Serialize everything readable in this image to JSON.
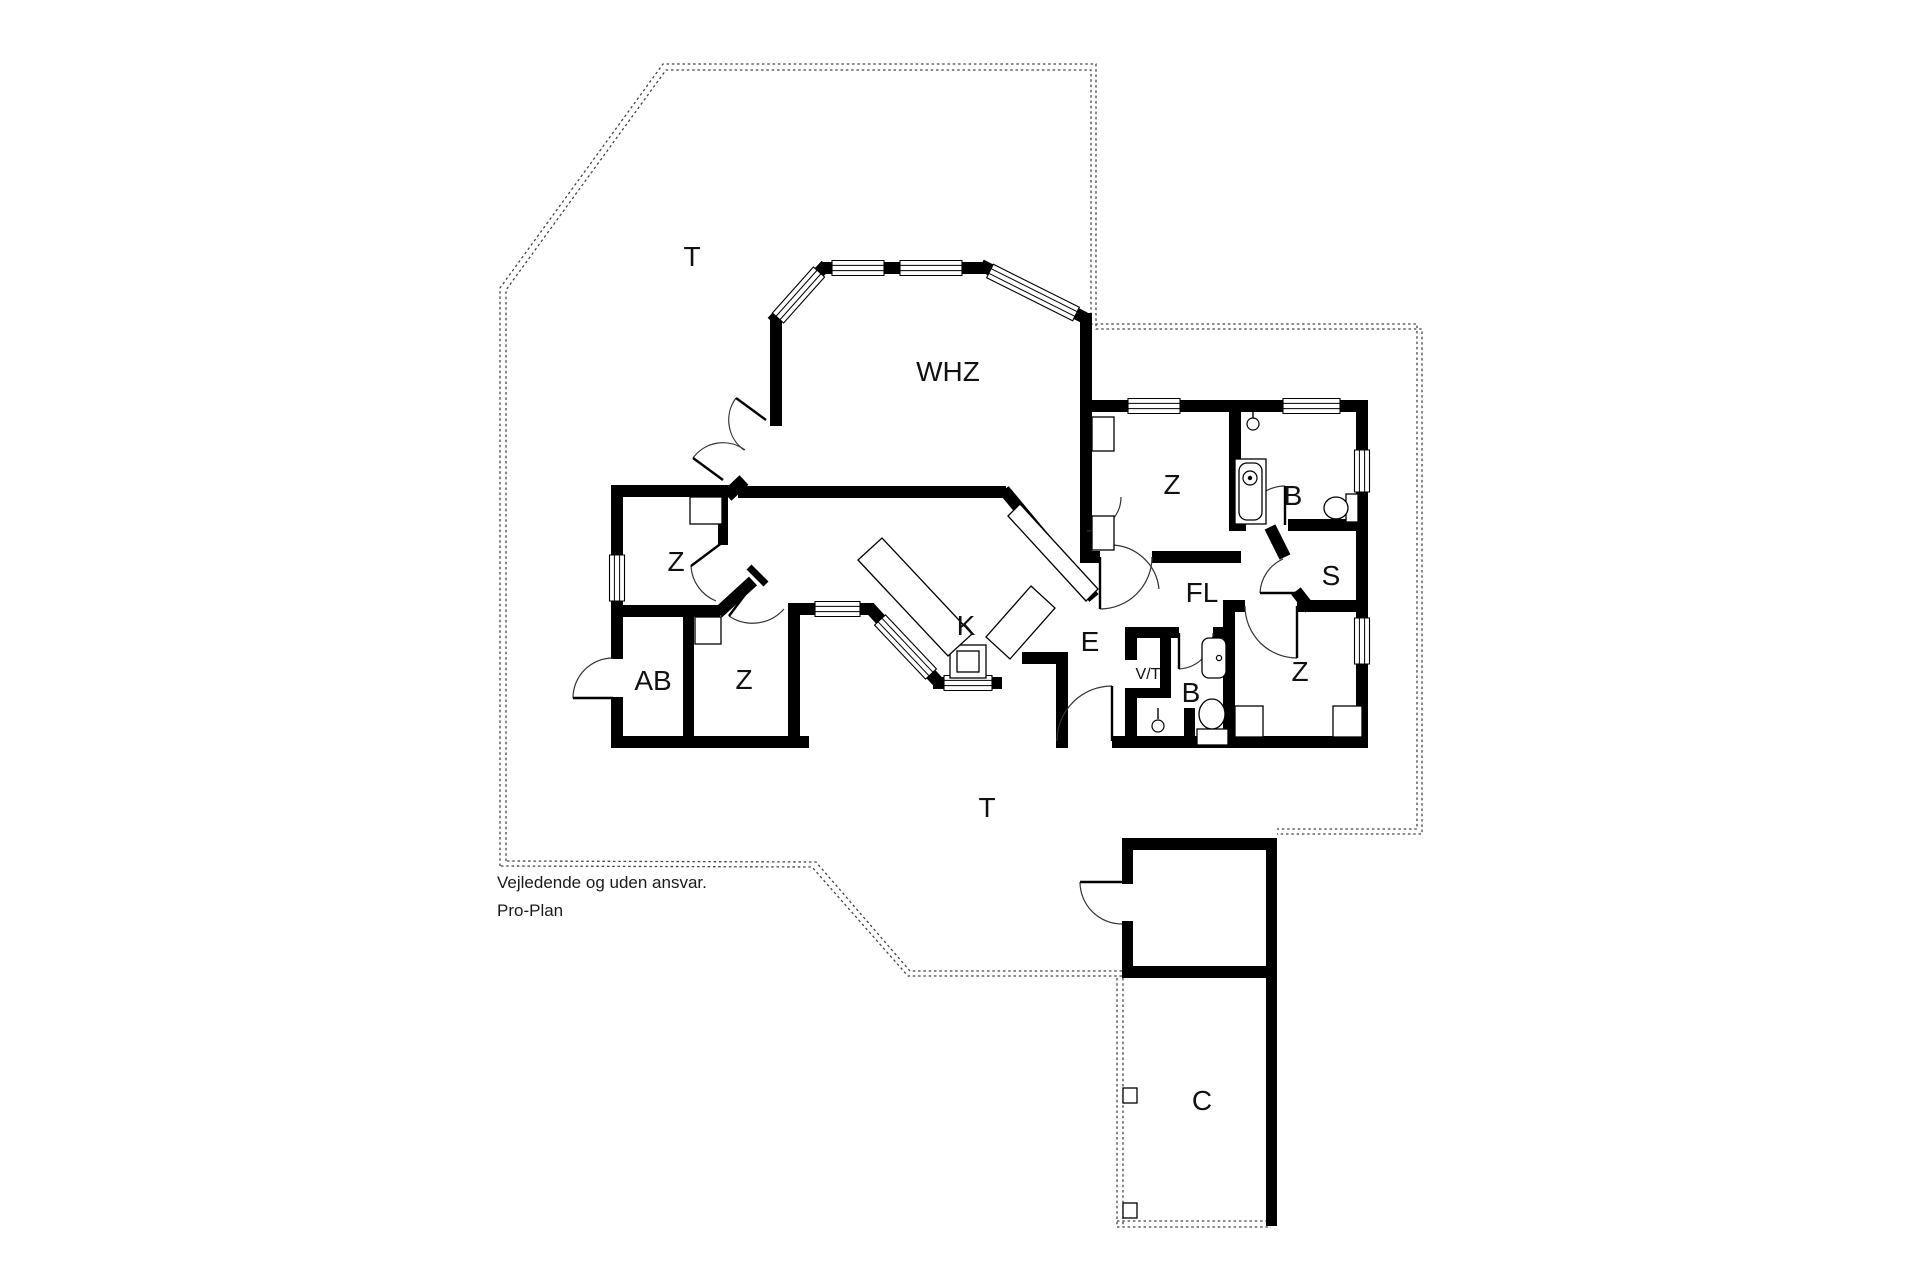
{
  "disclaimer": {
    "line1": "Vejledende og uden ansvar.",
    "line2": "Pro-Plan"
  },
  "colors": {
    "wall": "#000000",
    "paper": "#ffffff",
    "boundary_dash": "#444444",
    "label_text": "#111111"
  },
  "room_labels": [
    {
      "id": "terrace-top",
      "text": "T",
      "x": 692,
      "y": 266,
      "size": 28
    },
    {
      "id": "living-room",
      "text": "WHZ",
      "x": 948,
      "y": 381,
      "size": 28
    },
    {
      "id": "bedroom-top-right",
      "text": "Z",
      "x": 1172,
      "y": 494,
      "size": 28
    },
    {
      "id": "bath-top",
      "text": "B",
      "x": 1293,
      "y": 505,
      "size": 28
    },
    {
      "id": "sauna",
      "text": "S",
      "x": 1331,
      "y": 585,
      "size": 28
    },
    {
      "id": "hall",
      "text": "FL",
      "x": 1202,
      "y": 602,
      "size": 28
    },
    {
      "id": "bedroom-left-upper",
      "text": "Z",
      "x": 676,
      "y": 571,
      "size": 28
    },
    {
      "id": "utility-ab",
      "text": "AB",
      "x": 653,
      "y": 690,
      "size": 28
    },
    {
      "id": "bedroom-left-lower",
      "text": "Z",
      "x": 744,
      "y": 689,
      "size": 28
    },
    {
      "id": "kitchen",
      "text": "K",
      "x": 966,
      "y": 635,
      "size": 28
    },
    {
      "id": "dining",
      "text": "E",
      "x": 1090,
      "y": 651,
      "size": 28
    },
    {
      "id": "washer-dryer",
      "text": "V/T",
      "x": 1148,
      "y": 679,
      "size": 16
    },
    {
      "id": "bath-bottom",
      "text": "B",
      "x": 1191,
      "y": 702,
      "size": 28
    },
    {
      "id": "bedroom-bottom-right",
      "text": "Z",
      "x": 1300,
      "y": 681,
      "size": 28
    },
    {
      "id": "terrace-bottom",
      "text": "T",
      "x": 987,
      "y": 817,
      "size": 28
    },
    {
      "id": "carport",
      "text": "C",
      "x": 1202,
      "y": 1110,
      "size": 28
    }
  ],
  "geometry": {
    "walls": [
      [
        822,
        262,
        163,
        12
      ],
      [
        770,
        318,
        12,
        108
      ],
      [
        1080,
        313,
        12,
        99
      ],
      [
        1085,
        400,
        283,
        12
      ],
      [
        1356,
        400,
        12,
        348
      ],
      [
        1112,
        736,
        256,
        12
      ],
      [
        1058,
        736,
        10,
        12
      ],
      [
        738,
        486,
        268,
        12
      ],
      [
        613,
        485,
        119,
        12
      ],
      [
        611,
        485,
        12,
        122
      ],
      [
        613,
        605,
        107,
        12
      ],
      [
        683,
        605,
        11,
        143
      ],
      [
        611,
        607,
        12,
        52
      ],
      [
        611,
        697,
        12,
        51
      ],
      [
        611,
        736,
        198,
        12
      ],
      [
        788,
        605,
        12,
        143
      ],
      [
        788,
        603,
        86,
        12
      ],
      [
        933,
        677,
        69,
        12
      ],
      [
        1022,
        652,
        46,
        12
      ],
      [
        1056,
        652,
        12,
        96
      ],
      [
        1080,
        412,
        12,
        151
      ],
      [
        1080,
        551,
        20,
        12
      ],
      [
        1152,
        551,
        89,
        12
      ],
      [
        1229,
        412,
        12,
        119
      ],
      [
        1229,
        519,
        17,
        12
      ],
      [
        1288,
        519,
        80,
        12
      ],
      [
        1223,
        600,
        22,
        12
      ],
      [
        1297,
        600,
        71,
        12
      ],
      [
        1223,
        600,
        12,
        148
      ],
      [
        1125,
        627,
        54,
        11
      ],
      [
        1213,
        627,
        21,
        11
      ],
      [
        1125,
        627,
        12,
        33
      ],
      [
        1125,
        688,
        12,
        60
      ],
      [
        1160,
        638,
        11,
        60
      ],
      [
        1125,
        688,
        46,
        10
      ],
      [
        1184,
        708,
        11,
        34
      ],
      [
        1122,
        838,
        155,
        12
      ],
      [
        1122,
        838,
        11,
        46
      ],
      [
        1122,
        921,
        11,
        57
      ],
      [
        1266,
        838,
        11,
        140
      ],
      [
        1122,
        966,
        155,
        12
      ],
      [
        1266,
        978,
        11,
        248
      ],
      [
        718,
        497,
        10,
        48
      ]
    ],
    "diag_walls": [
      [
        826,
        265,
        772,
        322,
        12
      ],
      [
        981,
        265,
        1085,
        318,
        12
      ],
      [
        727,
        496,
        744,
        480,
        13
      ],
      [
        1004,
        490,
        1094,
        598,
        12
      ],
      [
        869,
        607,
        940,
        684,
        12
      ],
      [
        718,
        613,
        753,
        581,
        12
      ],
      [
        749,
        567,
        766,
        584,
        7
      ],
      [
        1270,
        527,
        1285,
        557,
        12
      ],
      [
        1296,
        591,
        1310,
        609,
        12
      ]
    ],
    "windows": [
      [
        832,
        268,
        884,
        268
      ],
      [
        900,
        268,
        962,
        268
      ],
      [
        1128,
        406,
        1180,
        406
      ],
      [
        1283,
        406,
        1340,
        406
      ],
      [
        944,
        683,
        992,
        683
      ],
      [
        815,
        609,
        860,
        609
      ],
      [
        617,
        555,
        617,
        601
      ],
      [
        1362,
        450,
        1362,
        492
      ],
      [
        1362,
        618,
        1362,
        664
      ],
      [
        819,
        272,
        778,
        318
      ],
      [
        990,
        271,
        1076,
        314
      ],
      [
        880,
        620,
        931,
        674
      ]
    ],
    "door_arcs": [
      {
        "a": "M744,450 A37 37 0 0 1 736,398",
        "l": [
          766,
          420,
          736,
          398
        ]
      },
      {
        "a": "M745,450 A37 37 0 0 0 693,458",
        "l": [
          723,
          480,
          693,
          458
        ]
      },
      {
        "a": "M573,698 A40 40 0 0 1 613,658",
        "l": [
          613,
          698,
          573,
          698
        ]
      },
      {
        "a": "M1080,882 A42 42 0 0 0 1122,924",
        "l": [
          1122,
          882,
          1080,
          882
        ]
      },
      {
        "a": "M1112,686 A55 55 0 0 0 1057,741",
        "l": [
          1112,
          741,
          1112,
          686
        ]
      },
      {
        "a": "M1213,633 A36 36 0 0 1 1179,669",
        "l": [
          1179,
          633,
          1179,
          669
        ]
      },
      {
        "a": "M1245,606 A52 52 0 0 0 1297,658",
        "l": [
          1297,
          606,
          1297,
          658
        ]
      },
      {
        "a": "M1152,557 A52 52 0 0 1 1100,609",
        "l": [
          1100,
          557,
          1100,
          609
        ]
      },
      {
        "a": "M1246,525 A39 39 0 0 1 1285,486",
        "l": [
          1285,
          525,
          1285,
          486
        ]
      },
      {
        "a": "M1283,559 A39 39 0 0 0 1260,593",
        "l": [
          1299,
          593,
          1260,
          593
        ]
      },
      {
        "a": "M691,566 A40 40 0 0 0 716,601",
        "l": [
          723,
          542,
          691,
          566
        ]
      },
      {
        "a": "M784,609 A42 42 0 0 1 729,616",
        "l": [
          753,
          584,
          729,
          616
        ]
      },
      {
        "a": "M1121,497 A34 34 0 0 1 1087,531",
        "l": null
      },
      {
        "a": "M1111,545 A49 49 0 0 1 1159,589",
        "l": null
      }
    ],
    "boundary_dashed": [
      "M 500,866 L 500,288 L 663,64 L 1096,64 L 1096,329 L 1422,329 L 1422,834 L 1277,834",
      "M 506,861 L 506,290 L 666,70 L 1091,70 L 1091,324 L 1417,324 L 1417,829 L 1277,829",
      "M 1122,976 L 908,976 L 812,867 L 500,866",
      "M 1122,971 L 910,971 L 816,862 L 506,861",
      "M 1117,978 L 1117,1226",
      "M 1123,978 L 1123,1226",
      "M 1117,1221 L 1271,1221",
      "M 1117,1227 L 1271,1227"
    ],
    "furniture_rects": [
      [
        690,
        497,
        32,
        27
      ],
      [
        1092,
        417,
        22,
        34
      ],
      [
        1092,
        516,
        22,
        34
      ],
      [
        1235,
        706,
        28,
        31
      ],
      [
        1333,
        706,
        29,
        31
      ],
      [
        695,
        617,
        26,
        27
      ],
      [
        950,
        645,
        36,
        33
      ],
      [
        957,
        651,
        22,
        21
      ],
      [
        1123,
        1088,
        14,
        15
      ],
      [
        1123,
        1203,
        14,
        15
      ]
    ],
    "furniture_polys": [
      [
        858,
        560,
        882,
        538,
        972,
        634,
        948,
        656
      ],
      [
        1031,
        586,
        1055,
        608,
        1010,
        659,
        986,
        637
      ],
      [
        1008,
        516,
        1020,
        504,
        1098,
        589,
        1086,
        601
      ]
    ],
    "fixtures": {
      "rects": [
        [
          1235,
          459,
          31,
          65
        ],
        [
          1346,
          494,
          12,
          28
        ],
        [
          1197,
          729,
          31,
          16
        ]
      ],
      "rrects": [
        [
          1239,
          463,
          23,
          57,
          8
        ],
        [
          1202,
          638,
          24,
          40,
          7
        ]
      ],
      "circles": [
        [
          1250,
          478,
          7
        ],
        [
          1250,
          478,
          1.6
        ],
        [
          1253,
          424,
          6
        ],
        [
          1219,
          658,
          2.6
        ],
        [
          1158,
          726,
          6
        ]
      ],
      "ellipses": [
        [
          1336,
          508,
          12,
          11
        ],
        [
          1212,
          714,
          13,
          15
        ]
      ],
      "lines": [
        [
          1253,
          418,
          1253,
          407
        ],
        [
          1158,
          719,
          1158,
          708
        ]
      ]
    }
  }
}
